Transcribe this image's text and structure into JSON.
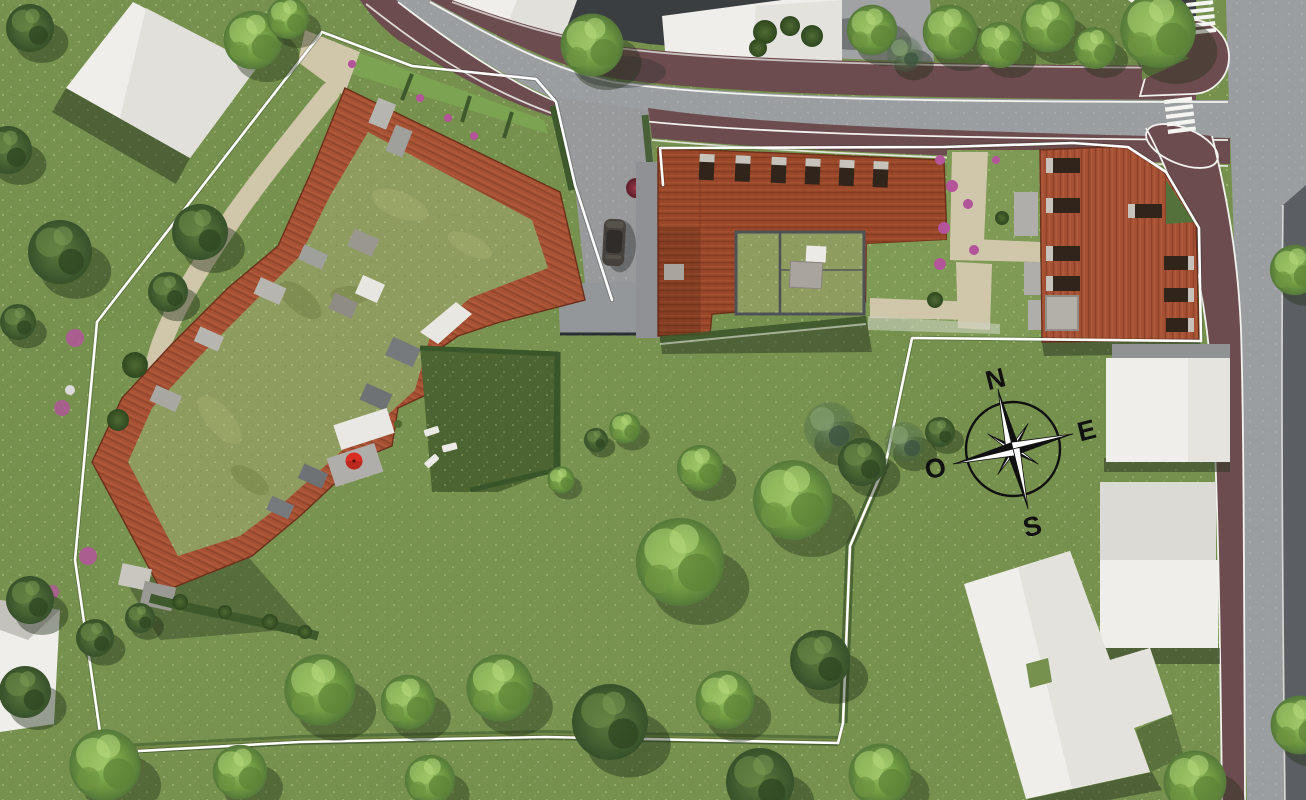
{
  "scene": {
    "description": "Aerial 3D architectural site plan: residential buildings with terracotta tile roofs and planted green roofs inside a white property-boundary line, surrounded by lawns, trees, roads with red-brown sidewalks, zebra crossings and neighbouring white-roofed houses",
    "compass": {
      "n": "N",
      "e": "E",
      "s": "S",
      "o": "O"
    },
    "colors": {
      "grass": "#76914e",
      "grass_light": "#86a159",
      "lawn_court": "#4b6431",
      "road": "#9b9ea1",
      "road_dark": "#54585c",
      "driveway": "#97999b",
      "pavement": "#a0a2a4",
      "sidewalk": "#6d4c4f",
      "yard_charcoal": "#3b3e41",
      "roof_tile": "#a75134",
      "roof_tile_dark": "#9a4729",
      "green_roof": "#8e9c5f",
      "gravel": "#d0c6aa",
      "building_white": "#efeeea",
      "building_grey": "#e2e0db",
      "shadow": "#27341f",
      "boundary": "#ffffff",
      "curb": "#f2f2ef",
      "compass_ink": "#101010",
      "umbrella": "#d92e21",
      "car": "#46413c",
      "flowers": "#b4549b",
      "flowers_red": "#84293a",
      "hedge": "#3e5a2d",
      "concrete_pad": "#b7b5b0",
      "parapet": "#e9e7e1",
      "balcony_grey": "#6f7275"
    }
  }
}
